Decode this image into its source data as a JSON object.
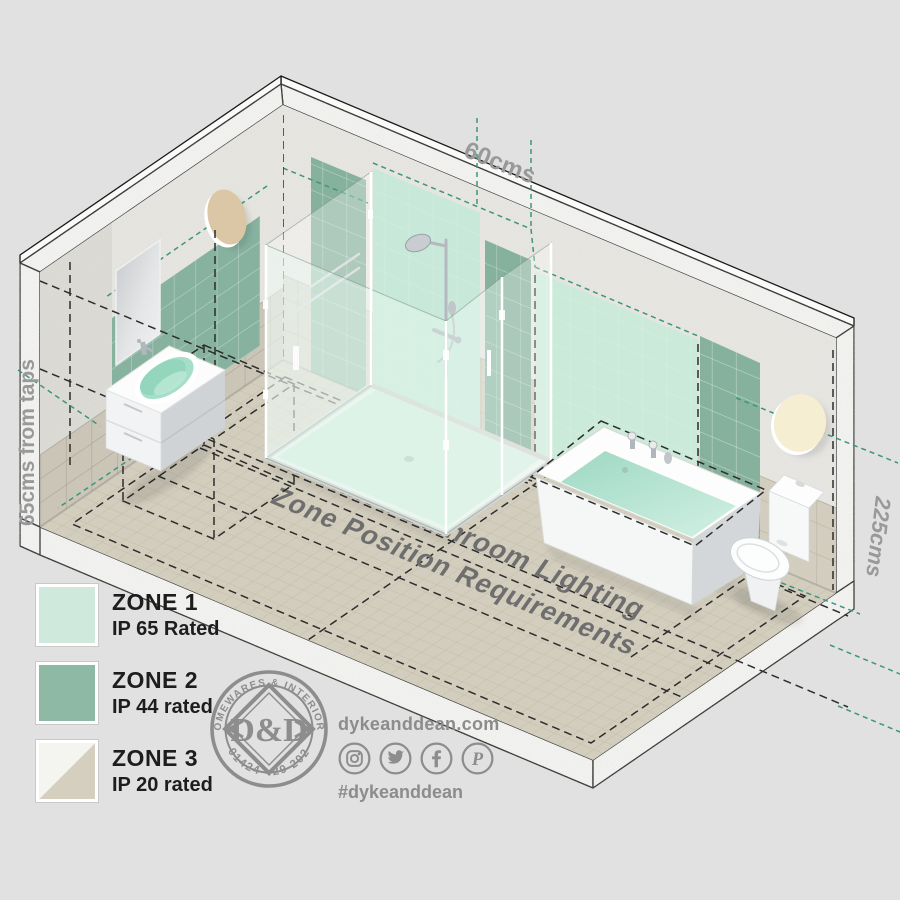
{
  "diagram": {
    "title_line1": "IP Rated Bathroom Lighting",
    "title_line2": "Zone Position Requirements",
    "dim_top": "60cms",
    "dim_left": "65cms from taps",
    "dim_right": "225cms"
  },
  "legend": {
    "items": [
      {
        "zone": "ZONE 1",
        "rating": "IP 65 Rated",
        "color": "#cfe9dd"
      },
      {
        "zone": "ZONE 2",
        "rating": "IP 44 rated",
        "color": "#8db9a5"
      },
      {
        "zone": "ZONE 3",
        "rating": "IP 20 rated",
        "color_a": "#f4f4f1",
        "color_b": "#d5cfc0"
      }
    ]
  },
  "branding": {
    "badge_arc_top": "HOMEWARES & INTERIORS",
    "badge_phone": "01424 429 202",
    "badge_monogram": "D&D",
    "website": "dykeanddean.com",
    "hashtag": "#dykeanddean",
    "social_icons": [
      "instagram",
      "twitter",
      "facebook",
      "pinterest"
    ]
  },
  "colors": {
    "background": "#e1e1e1",
    "zone1": "#cfe9dd",
    "zone2": "#8db9a5",
    "zone3_tile": "#d5cfc0",
    "teal_dash": "#3c967d",
    "label_gray": "#999999"
  }
}
